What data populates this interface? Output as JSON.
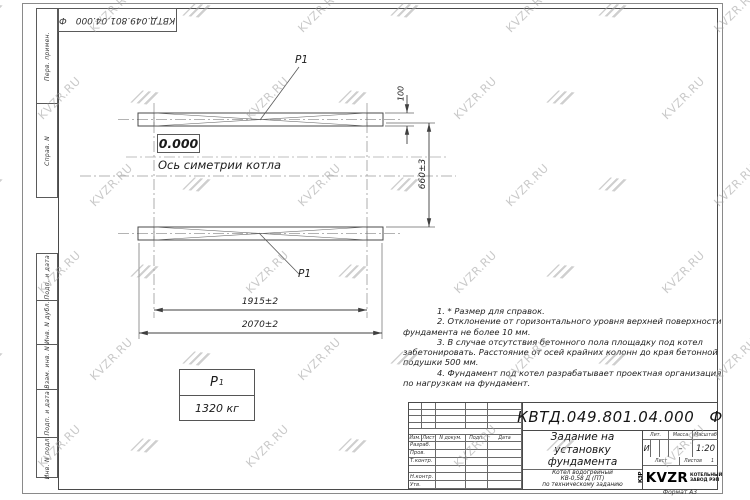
{
  "watermark": {
    "text": "KVZR.RU"
  },
  "stamp_top": {
    "designation": "КВТД.049.801.04.000",
    "suffix": "Ф"
  },
  "side_columns": {
    "top": [
      "Перв. примен.",
      "Справ. N"
    ],
    "bottom": [
      "Подп. и дата",
      "Инв. N дубл.",
      "Взам. инв. N",
      "Подп. и дата",
      "Инв. N подл."
    ]
  },
  "drawing": {
    "level_mark": "0.000",
    "axis_label": "Ось симетрии котла",
    "load_point_top": "Р1",
    "load_point_bottom": "Р1",
    "dims": {
      "thickness": "100",
      "row_spacing": "660±3",
      "span_inner": "1915±2",
      "span_outer": "2070±2"
    },
    "load_table": {
      "symbol": "Р",
      "symbol_sub": "1",
      "value": "1320 кг"
    }
  },
  "notes": {
    "lines": [
      "1. * Размер для справок.",
      "2. Отклонение от горизонтального уровня верхней поверхности",
      "фундамента не более 10 мм.",
      "3. В случае отсутствия бетонного пола площадку под котел",
      "забетонировать. Расстояние от осей крайних колонн до края бетонной",
      "подушки 500 мм.",
      "4. Фундамент под котел разрабатывает проектная организация",
      "по нагрузкам на фундамент."
    ]
  },
  "title_block": {
    "designation": "КВТД.049.801.04.000",
    "suffix": "Ф",
    "doc_title_lines": [
      "Задание на",
      "установку",
      "фундамента"
    ],
    "product_lines": [
      "Котел водогрейный",
      "КВ-0,58 Д (ПТ)",
      "по техническому заданию"
    ],
    "headers": {
      "izm": "Изм.",
      "list": "Лист",
      "n_dokum": "N докум.",
      "podp": "Подп.",
      "data": "Дата"
    },
    "rows": [
      "Разраб.",
      "Пров.",
      "Т.контр.",
      "",
      "Н.контр.",
      "Утв."
    ],
    "lit_label": "Лит.",
    "lit_value": "И",
    "massa_label": "Масса",
    "massa_value": "–",
    "masshtab_label": "Масштаб",
    "masshtab_value": "1:20",
    "list_label": "Лист",
    "listov_label": "Листов",
    "listov_value": "1",
    "logo": {
      "mark": "КЗР",
      "name": "KVZR",
      "line1": "КОТЕЛЬНЫЙ",
      "line2": "ЗАВОД РЭП"
    },
    "format": "Формат А3"
  }
}
